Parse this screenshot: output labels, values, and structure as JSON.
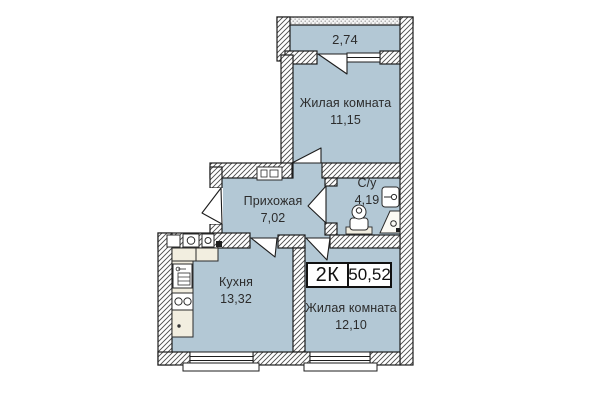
{
  "plan": {
    "summary": {
      "rooms_count_label": "2К",
      "total_area": "50,52"
    },
    "rooms": {
      "balcony": {
        "area": "2,74"
      },
      "living_room_1": {
        "name": "Жилая комната",
        "area": "11,15"
      },
      "hallway": {
        "name": "Прихожая",
        "area": "7,02"
      },
      "bathroom": {
        "name": "С/у",
        "area": "4,19"
      },
      "kitchen": {
        "name": "Кухня",
        "area": "13,32"
      },
      "living_room_2": {
        "name": "Жилая комната",
        "area": "12,10"
      }
    },
    "icons": [
      "toilet-icon",
      "bathroom-sink-icon",
      "corner-shower-icon",
      "kitchen-sink-icon",
      "stove-burners-icon",
      "washing-machine-icon",
      "window-icon",
      "door-leaf-icon",
      "water-heater-icon"
    ],
    "colors": {
      "room_fill": "#b3c8d5",
      "wall_outline": "#1d1d1d",
      "hatch_line": "#4a4a4a",
      "counter_fill": "#f2eee0",
      "fixture_fill": "#ffffff",
      "background": "#ffffff"
    }
  }
}
